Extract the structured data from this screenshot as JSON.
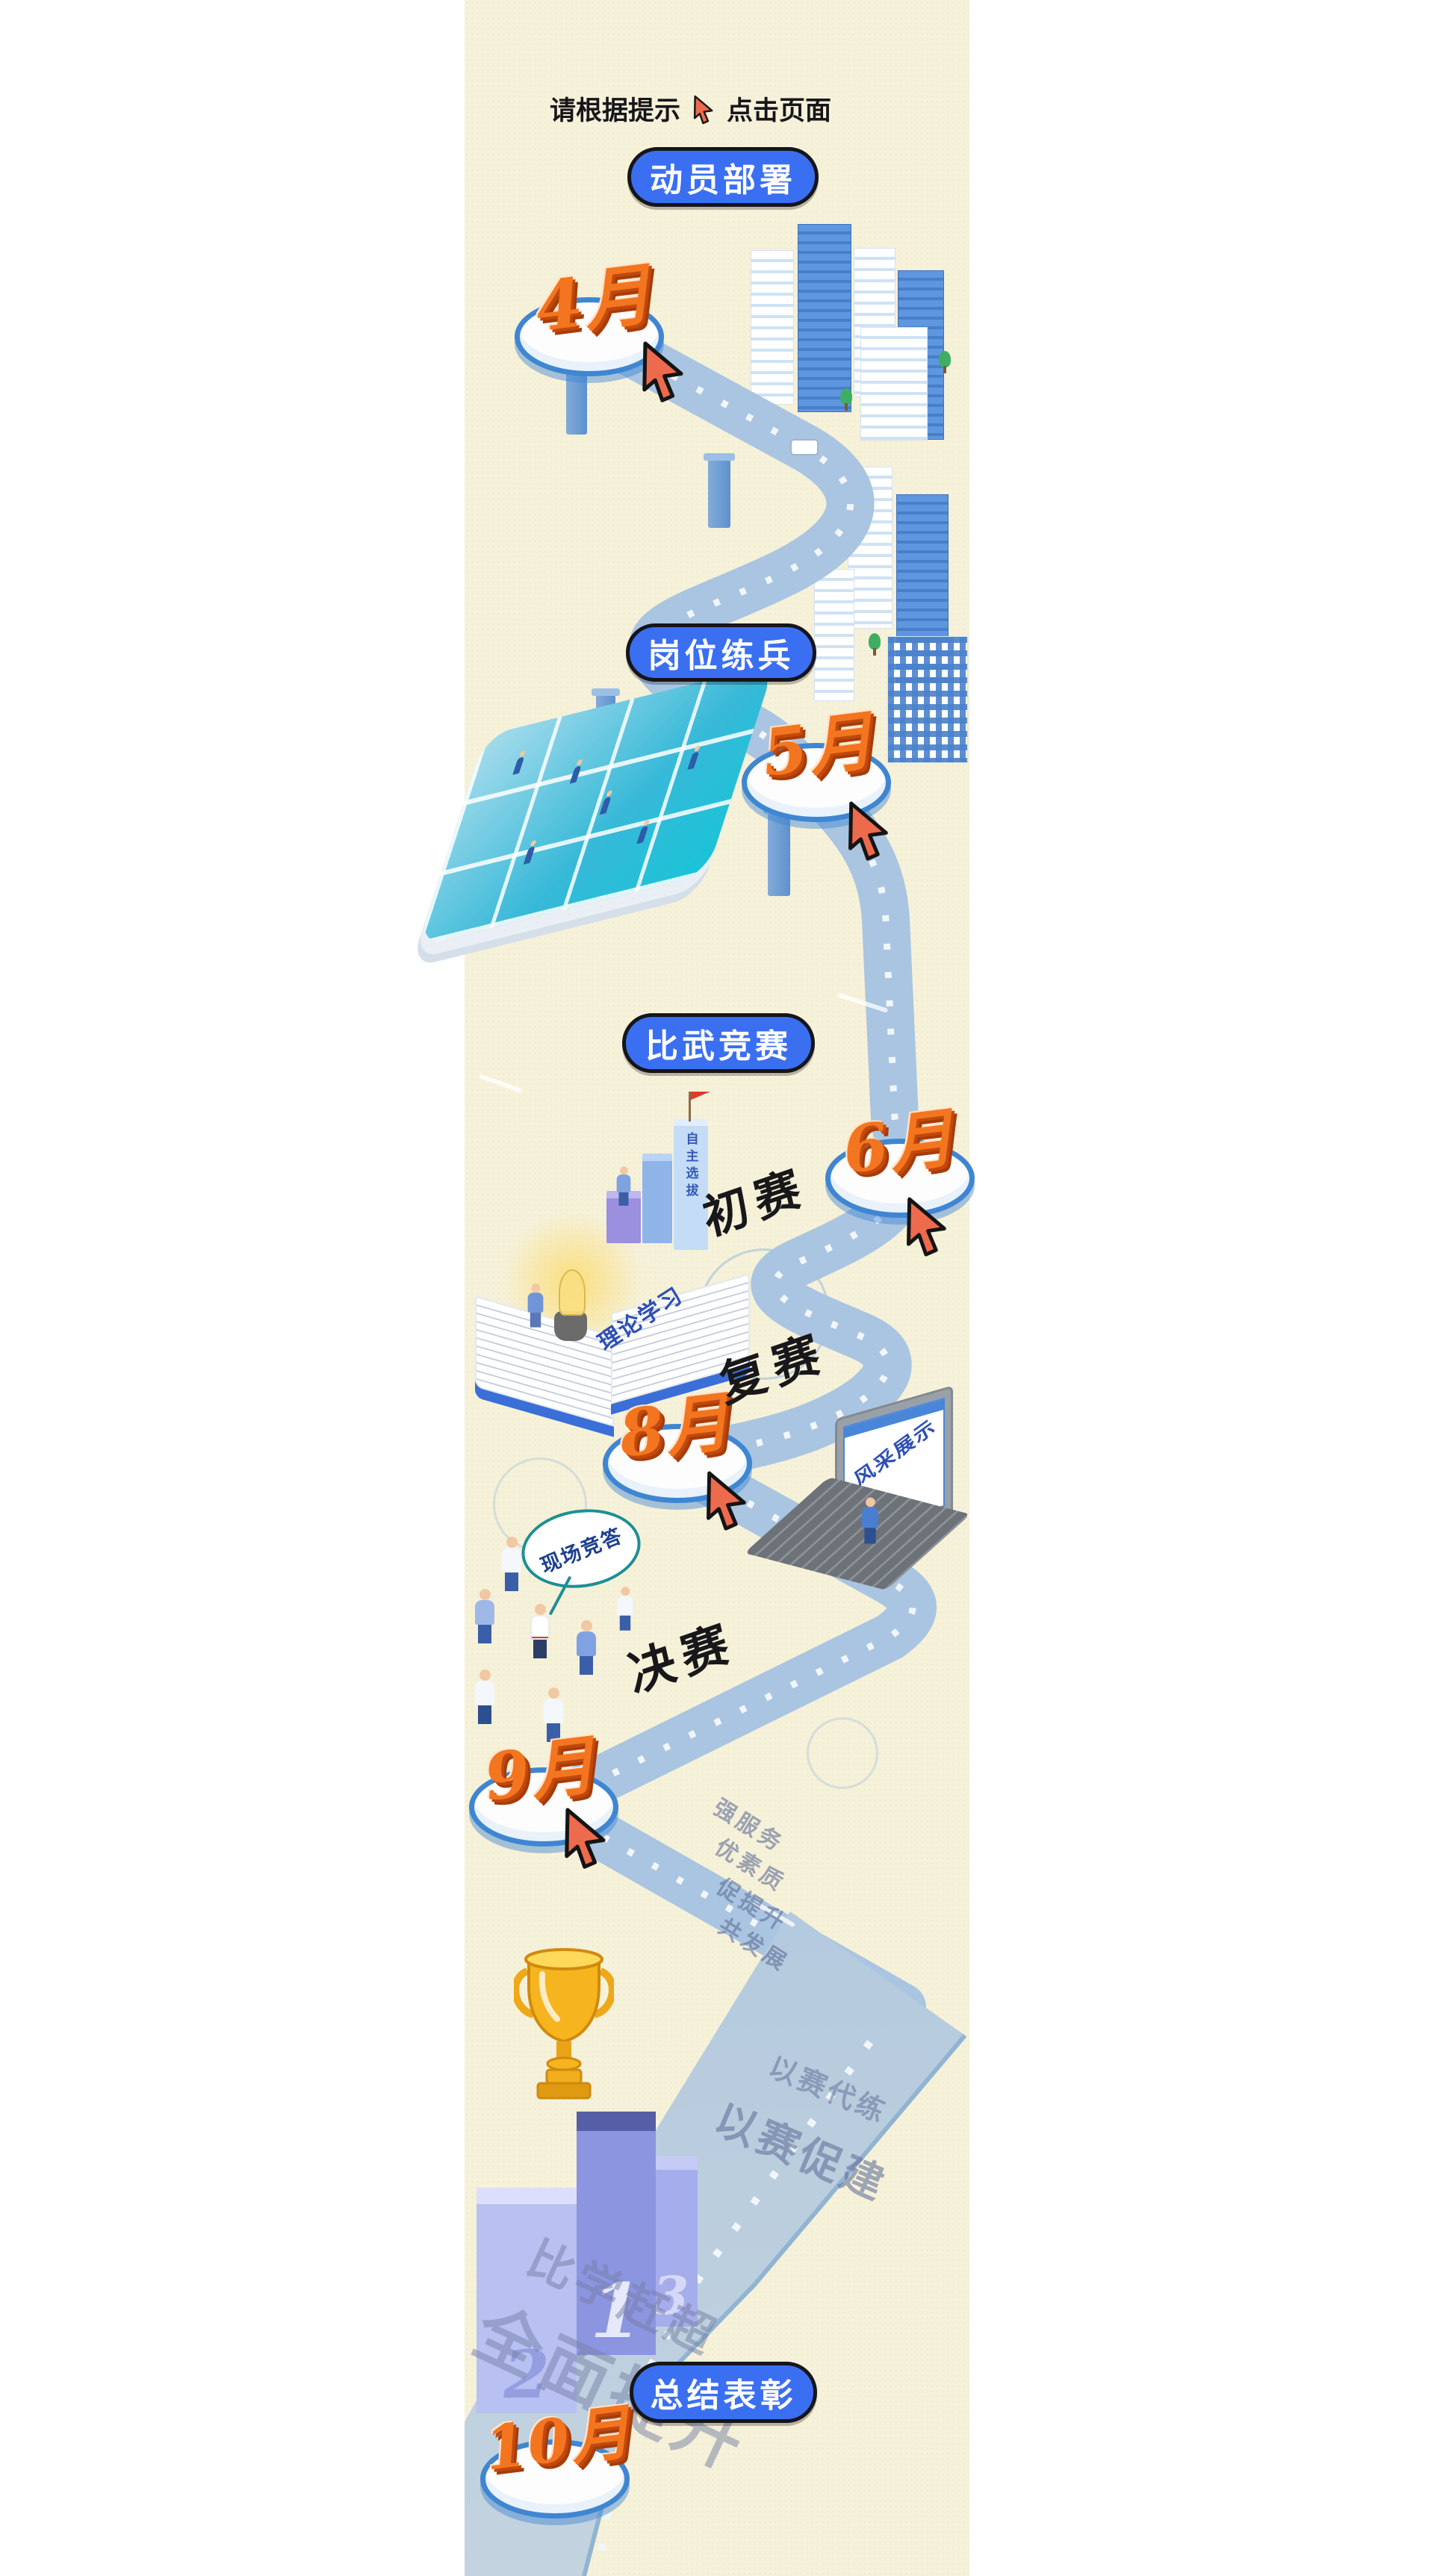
{
  "instruction": {
    "prefix": "请根据提示",
    "suffix": "点击页面"
  },
  "stages": [
    {
      "label": "动员部署"
    },
    {
      "label": "岗位练兵"
    },
    {
      "label": "比武竞赛"
    },
    {
      "label": "总结表彰"
    }
  ],
  "milestones": [
    {
      "month": "4月"
    },
    {
      "month": "5月"
    },
    {
      "month": "6月"
    },
    {
      "month": "8月"
    },
    {
      "month": "9月"
    },
    {
      "month": "10月"
    }
  ],
  "rounds": [
    {
      "label": "初赛",
      "note": "自主选拔"
    },
    {
      "label": "复赛",
      "note": "风采展示"
    },
    {
      "label": "决赛",
      "note": "现场竞答"
    }
  ],
  "book_label": "理论学习",
  "road_slogans": {
    "leg1": [
      "强服务",
      "优素质",
      "促提升",
      "共发展"
    ],
    "leg2": [
      "以赛代练",
      "以赛促建"
    ],
    "leg3": [
      "比学赶超",
      "全面提升"
    ]
  },
  "podium": {
    "first": "1",
    "second": "2",
    "third": "3"
  },
  "colors": {
    "accent_blue": "#3b6ff2",
    "road_blue": "#a9c5e1",
    "orange_3d": "#f4751f",
    "cursor_red": "#ee6a4d",
    "cream_bg": "#f6f1d9",
    "disc_rim": "#3f86d2"
  }
}
